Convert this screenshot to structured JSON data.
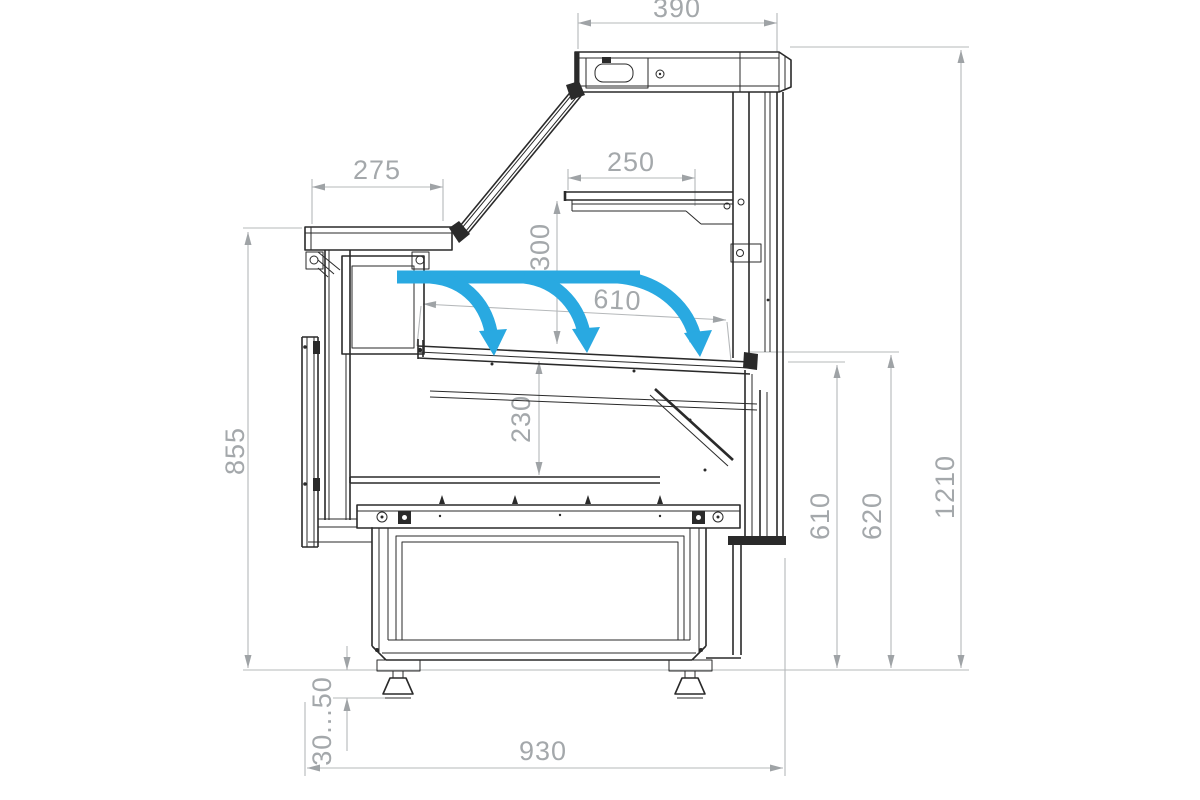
{
  "meta": {
    "type": "technical drawing",
    "subject": "serve-over refrigerated display counter, side cross-section with airflow"
  },
  "dims": {
    "canopy_width": "390",
    "counter_depth": "275",
    "shelf_depth": "250",
    "shelf_height": "300",
    "deck_width": "610",
    "well_depth": "230",
    "counter_height": "855",
    "rear_height_inner": "610",
    "rear_height_outer": "620",
    "total_height": "1210",
    "foot_adjust": "30...50",
    "base_width": "930"
  },
  "airflow": {
    "arrow_count": 3
  },
  "colors": {
    "airflow": "#29a9e1",
    "line": "#2a2a2a",
    "dim_line": "#b5b8ba",
    "dim_text": "#a4a8ab",
    "background": "#ffffff"
  }
}
